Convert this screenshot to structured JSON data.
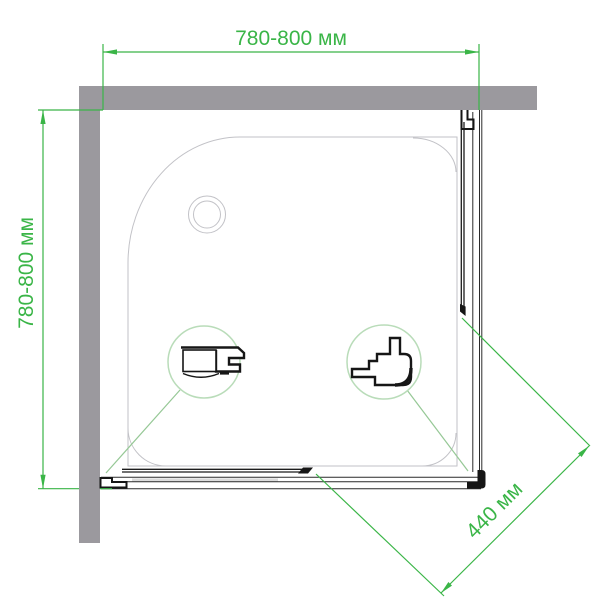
{
  "diagram": {
    "type": "shower-enclosure-top-view-technical-drawing",
    "labels": {
      "width_top": "780-800 мм",
      "depth_left": "780-800 мм",
      "entry_diagonal": "440 мм"
    },
    "colors": {
      "dimension_green": "#3ab547",
      "leader_green": "#96c896",
      "detail_circle_green": "#b9dcb9",
      "wall_gray": "#9b999e",
      "tray_outline_gray": "#c2c2c7",
      "profile_black": "#161616",
      "background": "#ffffff"
    }
  }
}
